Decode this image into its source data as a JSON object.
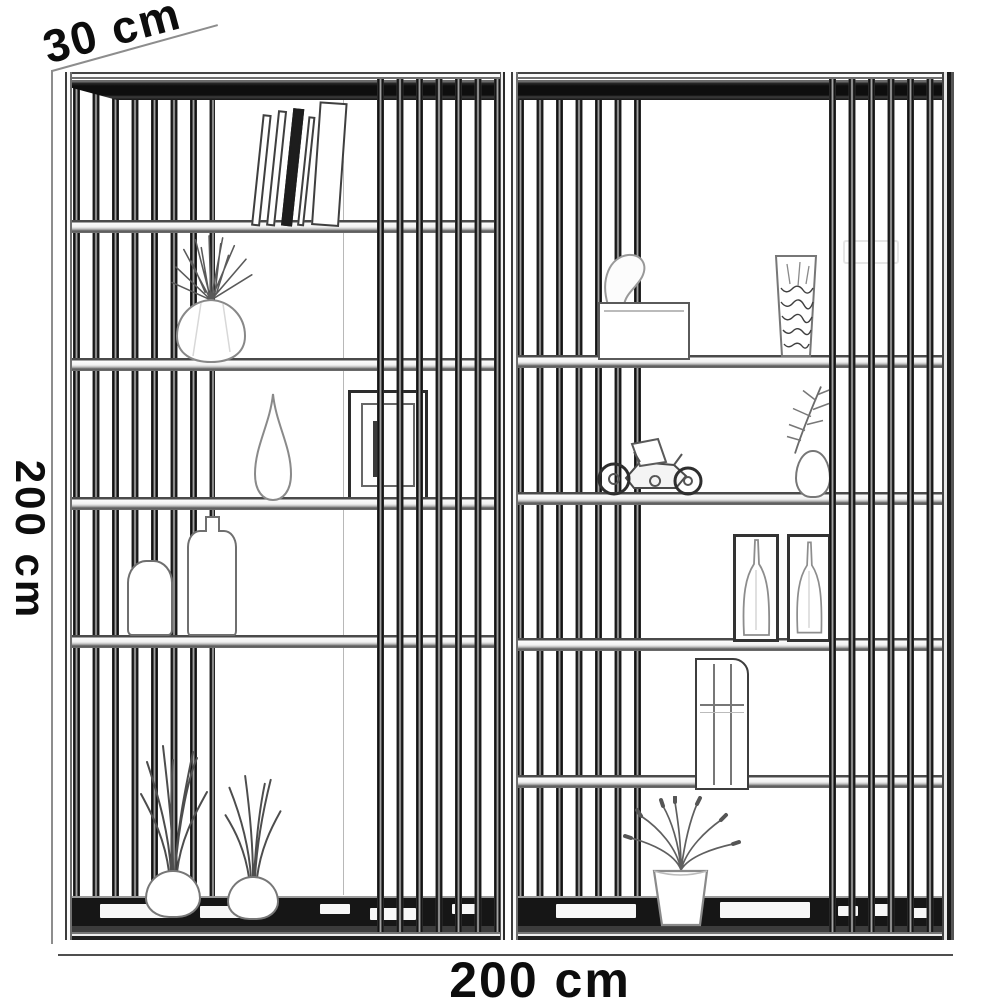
{
  "drawing": {
    "style": "black-and-white pencil sketch, furniture dimension drawing",
    "labels": {
      "depth": "30 cm",
      "height": "200 cm",
      "width": "200 cm"
    },
    "colors": {
      "paper": "#ffffff",
      "ink": "#161616",
      "dimension_line": "#8d8d8d"
    },
    "units": [
      {
        "name": "left bay",
        "shelf_count": 5,
        "slat_bands": [
          "left band behind shelves",
          "right band in front of shelves"
        ],
        "decor": [
          "leaning books",
          "faceted round vase with spiky plant",
          "teardrop vase",
          "picture frame",
          "round bottle",
          "tall bottle with cap",
          "grass in bud vase",
          "grass in bud vase"
        ]
      },
      {
        "name": "right bay",
        "shelf_count": 5,
        "slat_bands": [
          "left band behind shelves",
          "right band in front of shelves"
        ],
        "decor": [
          "folded napkin",
          "tissue box",
          "glass with dried stems",
          "toy motorcycle",
          "bud vase with fern branch",
          "bottle bookend",
          "bottle bookend",
          "vertical book file",
          "potted flowers"
        ]
      }
    ]
  }
}
